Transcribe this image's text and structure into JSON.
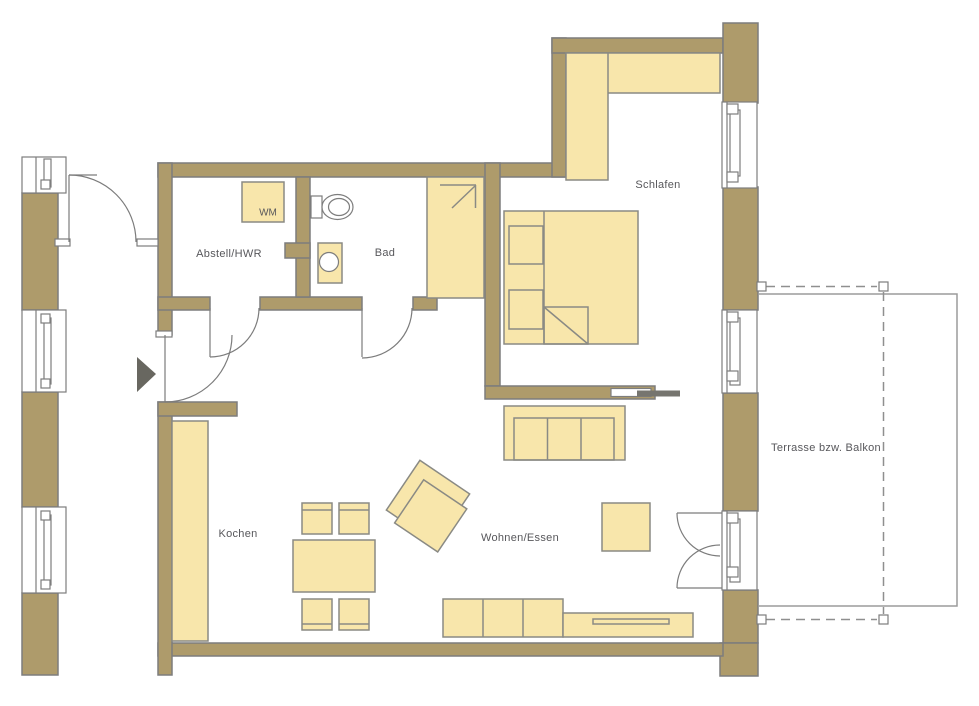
{
  "floor_plan": {
    "room_labels": {
      "abstell_hwr": "Abstell/HWR",
      "bad": "Bad",
      "schlafen": "Schlafen",
      "kochen": "Kochen",
      "wohnen_essen": "Wohnen/Essen",
      "terrasse": "Terrasse bzw. Balkon"
    },
    "appliance_labels": {
      "wm": "WM"
    },
    "colors": {
      "wall": "#ae9b6b",
      "wall_outline": "#7d7d7d",
      "furniture": "#f8e6ab",
      "furniture_outline": "#8a8a84",
      "label_text": "#57575b"
    }
  }
}
